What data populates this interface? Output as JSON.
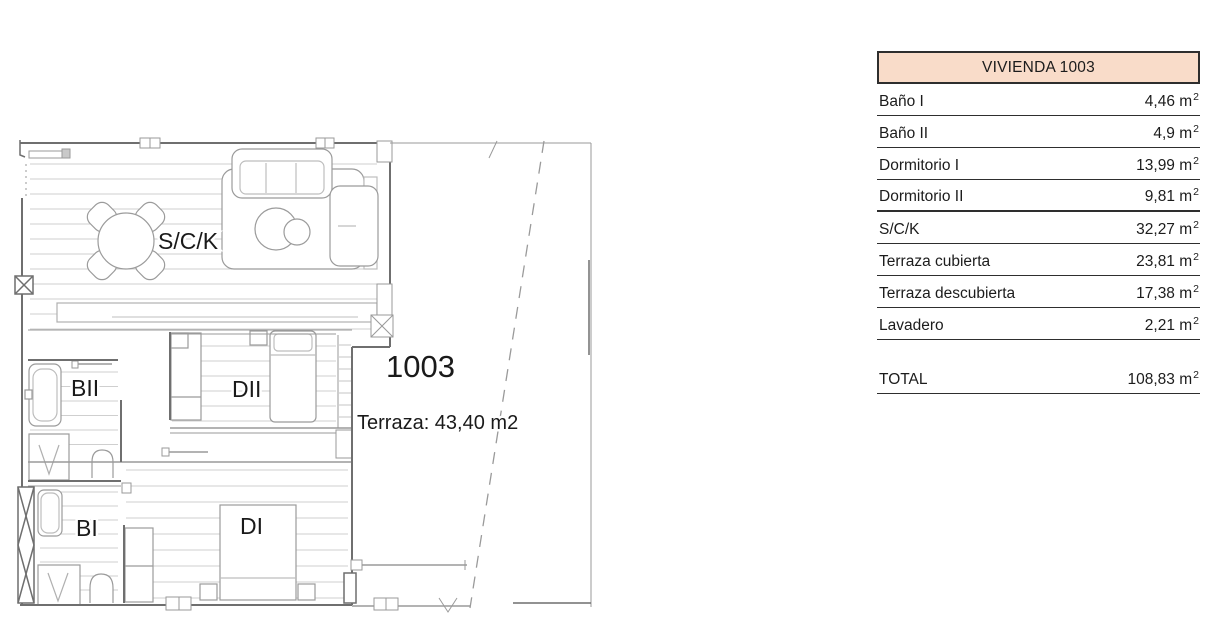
{
  "plan": {
    "unit_number": "1003",
    "unit_number_color": "#d32b28",
    "terrace_note": "Terraza: 43,40 m2",
    "labels": {
      "sck": "S/C/K",
      "bathroom2": "BII",
      "bedroom2": "DII",
      "bathroom1": "BI",
      "bedroom1": "DI"
    }
  },
  "table": {
    "title": "VIVIENDA 1003",
    "header_bg": "#f9dcc9",
    "unit": "m",
    "unit_sup": "2",
    "rows": [
      {
        "label": "Baño I",
        "value": "4,46"
      },
      {
        "label": "Baño II",
        "value": "4,9"
      },
      {
        "label": "Dormitorio I",
        "value": "13,99"
      },
      {
        "label": "Dormitorio II",
        "value": "9,81"
      },
      {
        "label": "S/C/K",
        "value": "32,27"
      },
      {
        "label": "Terraza cubierta",
        "value": "23,81"
      },
      {
        "label": "Terraza descubierta",
        "value": "17,38"
      },
      {
        "label": "Lavadero",
        "value": "2,21"
      }
    ],
    "total": {
      "label": "TOTAL",
      "value": "108,83"
    }
  }
}
